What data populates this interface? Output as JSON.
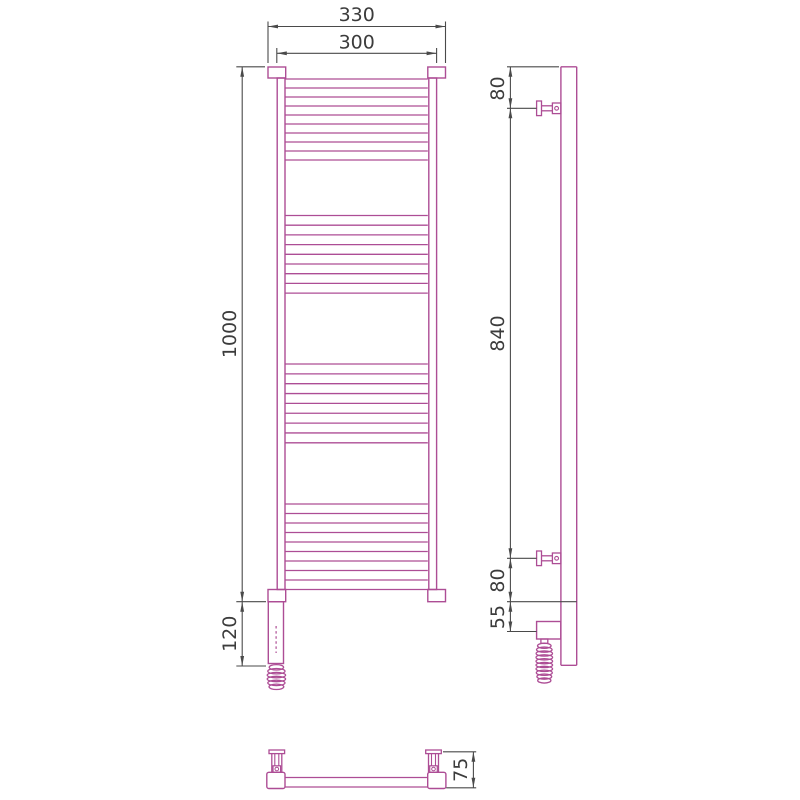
{
  "drawing_type": "technical-drawing",
  "subject": "Ladder towel radiator with electric heating element shown in front, side and bottom orthographic views",
  "colors": {
    "product_line": "#ad4d95",
    "dimension_line": "#4a4a4a",
    "text": "#3c3c3c",
    "background": "#ffffff"
  },
  "front_view": {
    "name": "front view",
    "bar_groups": [
      10,
      9,
      9,
      10
    ],
    "dimensions": [
      {
        "id": "width-outer",
        "label": "330",
        "orientation": "horizontal"
      },
      {
        "id": "width-rails",
        "label": "300",
        "orientation": "horizontal"
      },
      {
        "id": "height-main",
        "label": "1000",
        "orientation": "vertical"
      },
      {
        "id": "height-bottom",
        "label": "120",
        "orientation": "vertical"
      }
    ],
    "features": [
      "top collars",
      "bottom collars",
      "left rail",
      "right rail",
      "heating-element housing",
      "dashed element axis",
      "coiled power cable"
    ]
  },
  "side_view": {
    "name": "side view",
    "dimensions": [
      {
        "id": "bracket-top-offset",
        "label": "80",
        "orientation": "vertical"
      },
      {
        "id": "bracket-span",
        "label": "840",
        "orientation": "vertical"
      },
      {
        "id": "bracket-bottom-offset",
        "label": "80",
        "orientation": "vertical"
      },
      {
        "id": "heater-axis-offset",
        "label": "55",
        "orientation": "vertical"
      }
    ],
    "features": [
      "vertical tube",
      "upper wall bracket",
      "lower wall bracket",
      "heater box",
      "coiled power cable"
    ]
  },
  "bottom_view": {
    "name": "bottom view",
    "dimensions": [
      {
        "id": "depth",
        "label": "75",
        "orientation": "vertical"
      }
    ],
    "features": [
      "left end block",
      "right end block",
      "cross tube",
      "two wall brackets"
    ]
  }
}
